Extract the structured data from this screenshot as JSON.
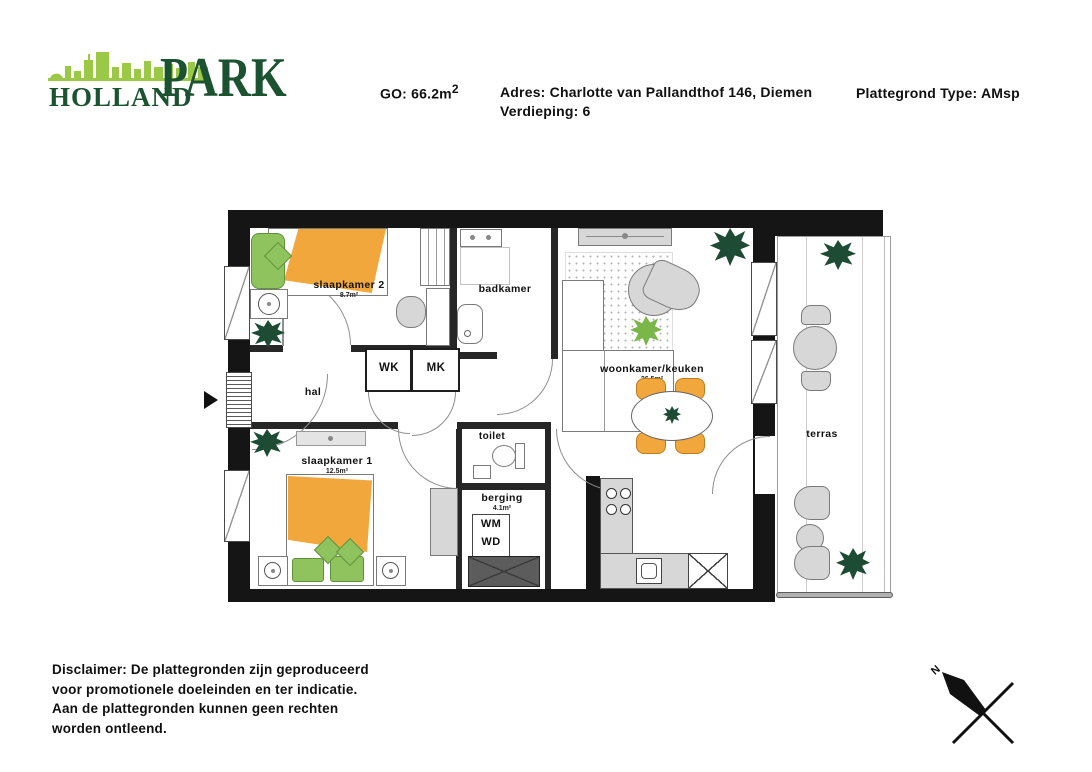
{
  "header": {
    "logo_line1": "HOLLAND",
    "logo_line2": "PARK",
    "go_prefix": "GO: 66.2m",
    "go_sup": "2",
    "adres": "Adres: Charlotte van Pallandthof 146, Diemen",
    "verdieping": "Verdieping: 6",
    "plattegrond_type": "Plattegrond Type: AMsp"
  },
  "rooms": {
    "slaapkamer2": {
      "name": "slaapkamer 2",
      "area": "8.7m²"
    },
    "badkamer": {
      "name": "badkamer"
    },
    "woonkamer": {
      "name": "woonkamer/keuken",
      "area": "26.5m²"
    },
    "hal": {
      "name": "hal"
    },
    "wk": "WK",
    "mk": "MK",
    "toilet": {
      "name": "toilet"
    },
    "berging": {
      "name": "berging",
      "area": "4.1m²"
    },
    "slaapkamer1": {
      "name": "slaapkamer 1",
      "area": "12.5m²"
    },
    "terras": {
      "name": "terras"
    }
  },
  "laundry": {
    "wm": "WM",
    "wd": "WD"
  },
  "disclaimer": {
    "line1": "Disclaimer: De plattegronden zijn geproduceerd",
    "line2": "voor promotionele doeleinden en ter indicatie.",
    "line3": "Aan de plattegronden kunnen geen rechten",
    "line4": "worden ontleend."
  },
  "compass": {
    "label": "N"
  },
  "colors": {
    "wall": "#151515",
    "accent_orange": "#f2a73c",
    "accent_green": "#8fc35d",
    "plant_green": "#1d4b33",
    "logo_dark_green": "#1b5230",
    "logo_lime": "#9cc945"
  }
}
